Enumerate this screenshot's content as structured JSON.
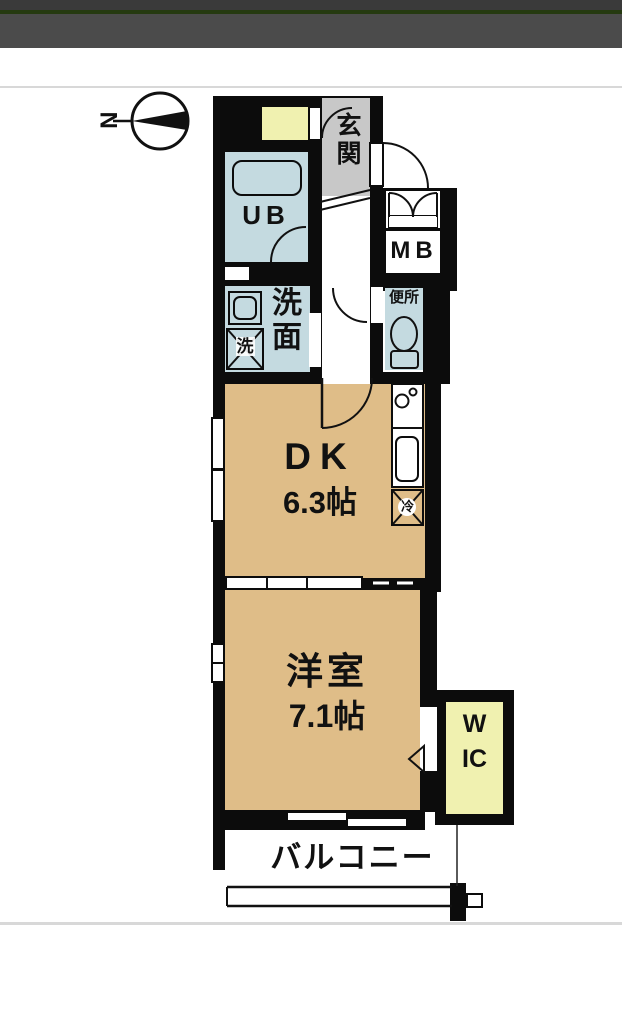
{
  "compass": {
    "label": "N"
  },
  "rooms": {
    "genkan": {
      "label": "玄関"
    },
    "unit_bath": {
      "label": "UB"
    },
    "meter_box": {
      "label": "MB"
    },
    "washroom": {
      "label": "洗面"
    },
    "washing_machine": {
      "label": "洗"
    },
    "toilet": {
      "label": "便所"
    },
    "dining_kitchen": {
      "label": "DK",
      "size": "6.3帖"
    },
    "refrigerator": {
      "label": "冷"
    },
    "western_room": {
      "label": "洋室",
      "size": "7.1帖"
    },
    "walk_in_closet": {
      "label": "WIC"
    },
    "balcony": {
      "label": "バルコニー"
    }
  },
  "colors": {
    "wall": "#0c0c0c",
    "tan": "#dfbd88",
    "blue": "#c4dae0",
    "gray": "#c8c8c8",
    "cream": "#f0f1b0",
    "header-dark": "#3a3a3a",
    "header-green": "#253a10",
    "header-gray": "#4b4b4b",
    "divider": "#d8d8d8",
    "ink": "#111111"
  }
}
